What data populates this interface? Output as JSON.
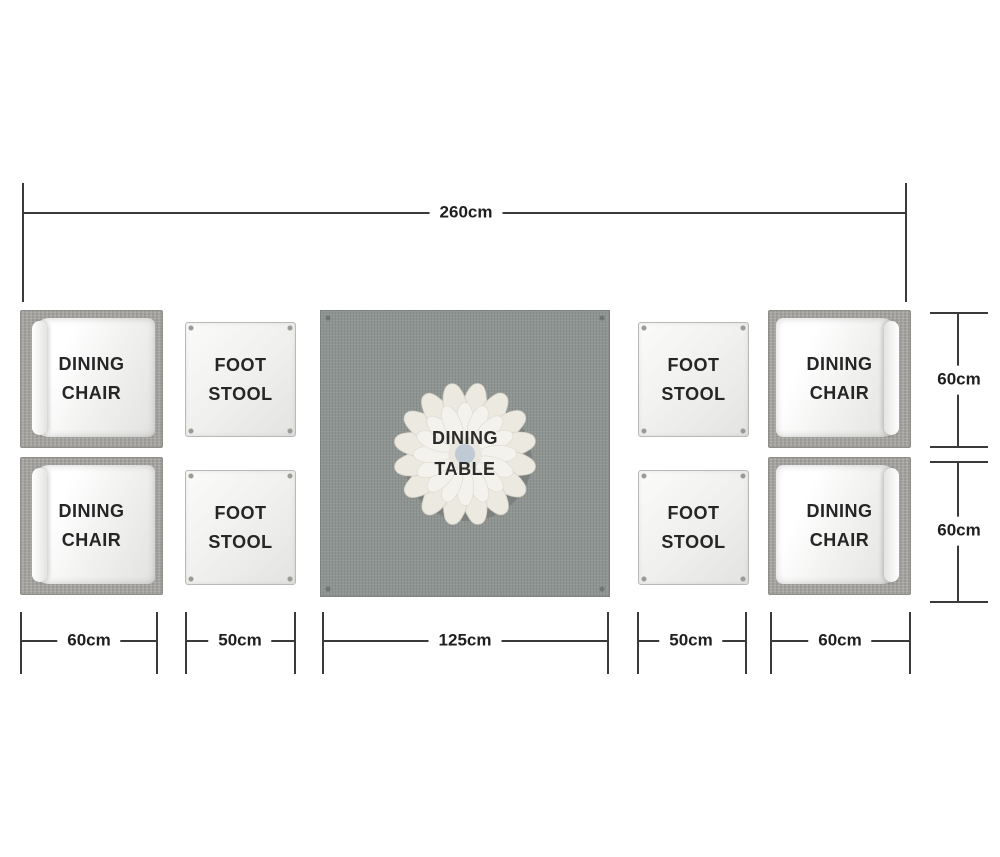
{
  "dimensions": {
    "overall_width": "260cm",
    "bottom": [
      "60cm",
      "50cm",
      "125cm",
      "50cm",
      "60cm"
    ],
    "right": [
      "60cm",
      "60cm"
    ]
  },
  "furniture": {
    "chairs": [
      "DINING CHAIR",
      "DINING CHAIR",
      "DINING CHAIR",
      "DINING CHAIR"
    ],
    "stools": [
      "FOOT STOOL",
      "FOOT STOOL",
      "FOOT STOOL",
      "FOOT STOOL"
    ],
    "table": "DINING TABLE"
  },
  "colors": {
    "background": "#ffffff",
    "dimension_line": "#3a3a3a",
    "label_text": "#1f1f1f",
    "table_top": "#8f9592",
    "wicker_frame": "#a6a5a2",
    "cushion": "#f7f7f6",
    "stool": "#efefed",
    "flower_petals": "#f0eee7",
    "flower_center": "#bfcad4"
  }
}
